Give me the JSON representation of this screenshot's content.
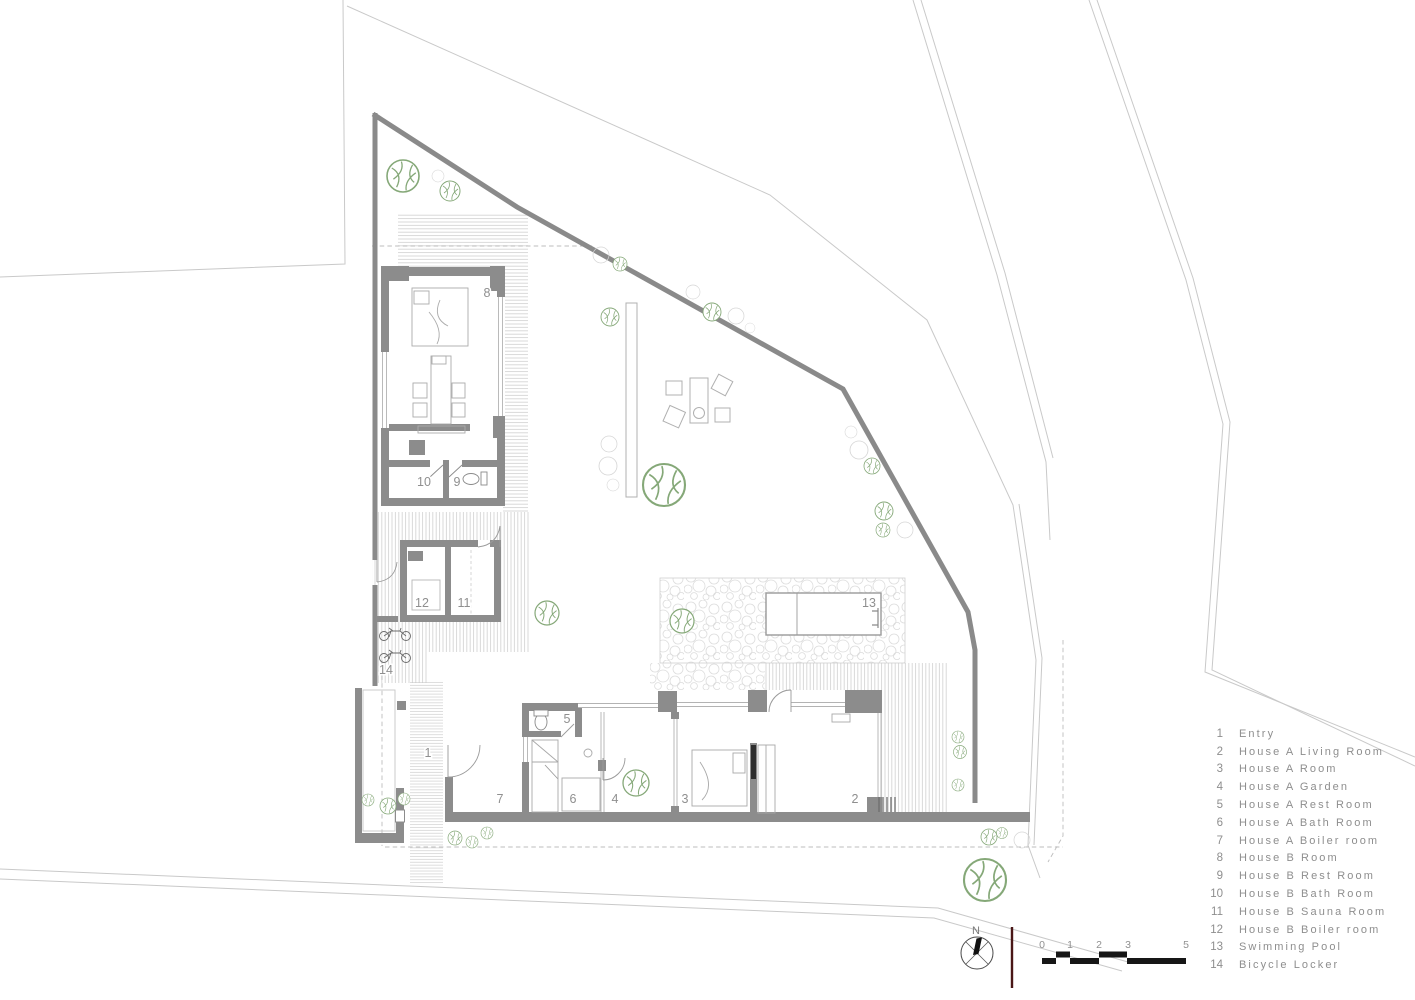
{
  "plan": {
    "labels": [
      {
        "n": "1"
      },
      {
        "n": "2"
      },
      {
        "n": "3"
      },
      {
        "n": "4"
      },
      {
        "n": "5"
      },
      {
        "n": "6"
      },
      {
        "n": "7"
      },
      {
        "n": "8"
      },
      {
        "n": "9"
      },
      {
        "n": "10"
      },
      {
        "n": "11"
      },
      {
        "n": "12"
      },
      {
        "n": "13"
      },
      {
        "n": "14"
      }
    ],
    "compass_label": "N",
    "scale_ticks": [
      "0",
      "1",
      "2",
      "3",
      "5"
    ]
  },
  "legend": {
    "items": [
      {
        "num": "1",
        "label": "Entry"
      },
      {
        "num": "2",
        "label": "House A Living Room"
      },
      {
        "num": "3",
        "label": "House A Room"
      },
      {
        "num": "4",
        "label": "House A Garden"
      },
      {
        "num": "5",
        "label": "House A Rest Room"
      },
      {
        "num": "6",
        "label": "House A Bath Room"
      },
      {
        "num": "7",
        "label": "House A Boiler room"
      },
      {
        "num": "8",
        "label": "House B Room"
      },
      {
        "num": "9",
        "label": "House B Rest Room"
      },
      {
        "num": "10",
        "label": "House B Bath Room"
      },
      {
        "num": "11",
        "label": "House B Sauna Room"
      },
      {
        "num": "12",
        "label": "House B Boiler room"
      },
      {
        "num": "13",
        "label": "Swimming Pool"
      },
      {
        "num": "14",
        "label": "Bicycle Locker"
      }
    ]
  },
  "colors": {
    "wall_gray": "#8c8c8c",
    "context_line": "#c9c9c9",
    "tree_green": "#85a878",
    "legend_text": "#8e8e8e",
    "scale_bar_black": "#161616",
    "north_line_maroon": "#4a1717"
  }
}
